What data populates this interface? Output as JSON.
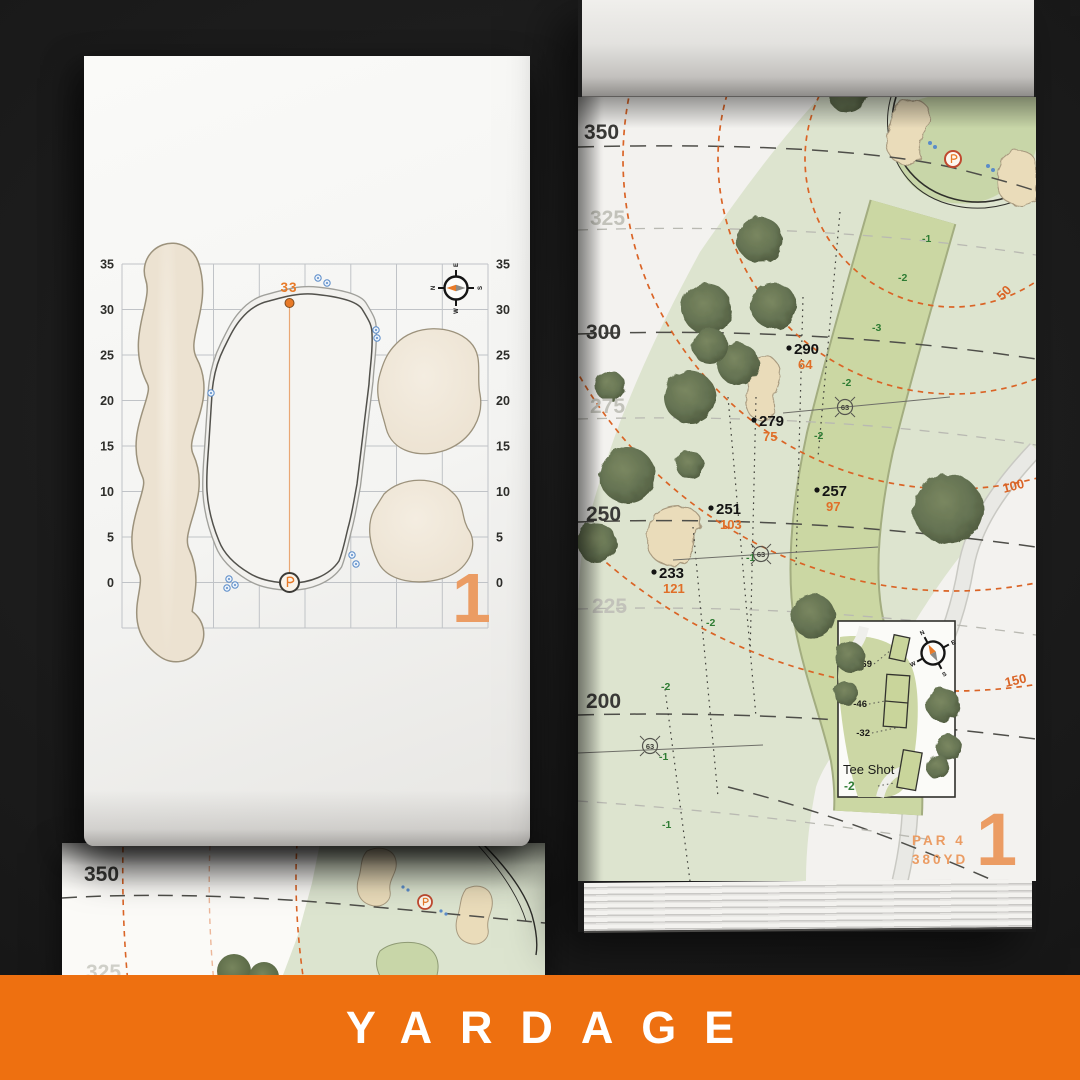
{
  "banner": {
    "title": "YARDAGE"
  },
  "compass": {
    "n": "N",
    "e": "E",
    "s": "S",
    "w": "W"
  },
  "left_page": {
    "hole_number": "1",
    "pin_carry": "33",
    "axis_left": [
      "35",
      "30",
      "25",
      "20",
      "15",
      "10",
      "5",
      "0"
    ],
    "axis_right": [
      "35",
      "30",
      "25",
      "20",
      "15",
      "10",
      "5",
      "0"
    ]
  },
  "under_page": {
    "labels": {
      "d350": "350",
      "d325": "325"
    }
  },
  "right_page": {
    "hole_number": "1",
    "par_label": "PAR 4",
    "yardage_label": "380YD",
    "distances": [
      "350",
      "325",
      "300",
      "275",
      "250",
      "225",
      "200"
    ],
    "arc_labels": [
      "50",
      "100",
      "150"
    ],
    "carry_points": [
      {
        "carry": "290",
        "to_green": "64"
      },
      {
        "carry": "279",
        "to_green": "75"
      },
      {
        "carry": "257",
        "to_green": "97"
      },
      {
        "carry": "251",
        "to_green": "103"
      },
      {
        "carry": "233",
        "to_green": "121"
      }
    ],
    "elevations": [
      "-1",
      "-2",
      "-3",
      "-2",
      "-2",
      "-1",
      "-2",
      "-2",
      "-1",
      "-1"
    ],
    "sprinkler_yardages": [
      "63",
      "63",
      "63"
    ],
    "tee_box": {
      "title": "Tee Shot",
      "elevation": "-2",
      "offsets": [
        "-69",
        "-46",
        "-32"
      ]
    }
  },
  "colors": {
    "banner_orange": "#ee7010",
    "accent_orange": "#e87a28",
    "arc_orange": "#da6426",
    "elevation_green": "#2e7c33",
    "numeral_orange": "#eb9c63"
  }
}
